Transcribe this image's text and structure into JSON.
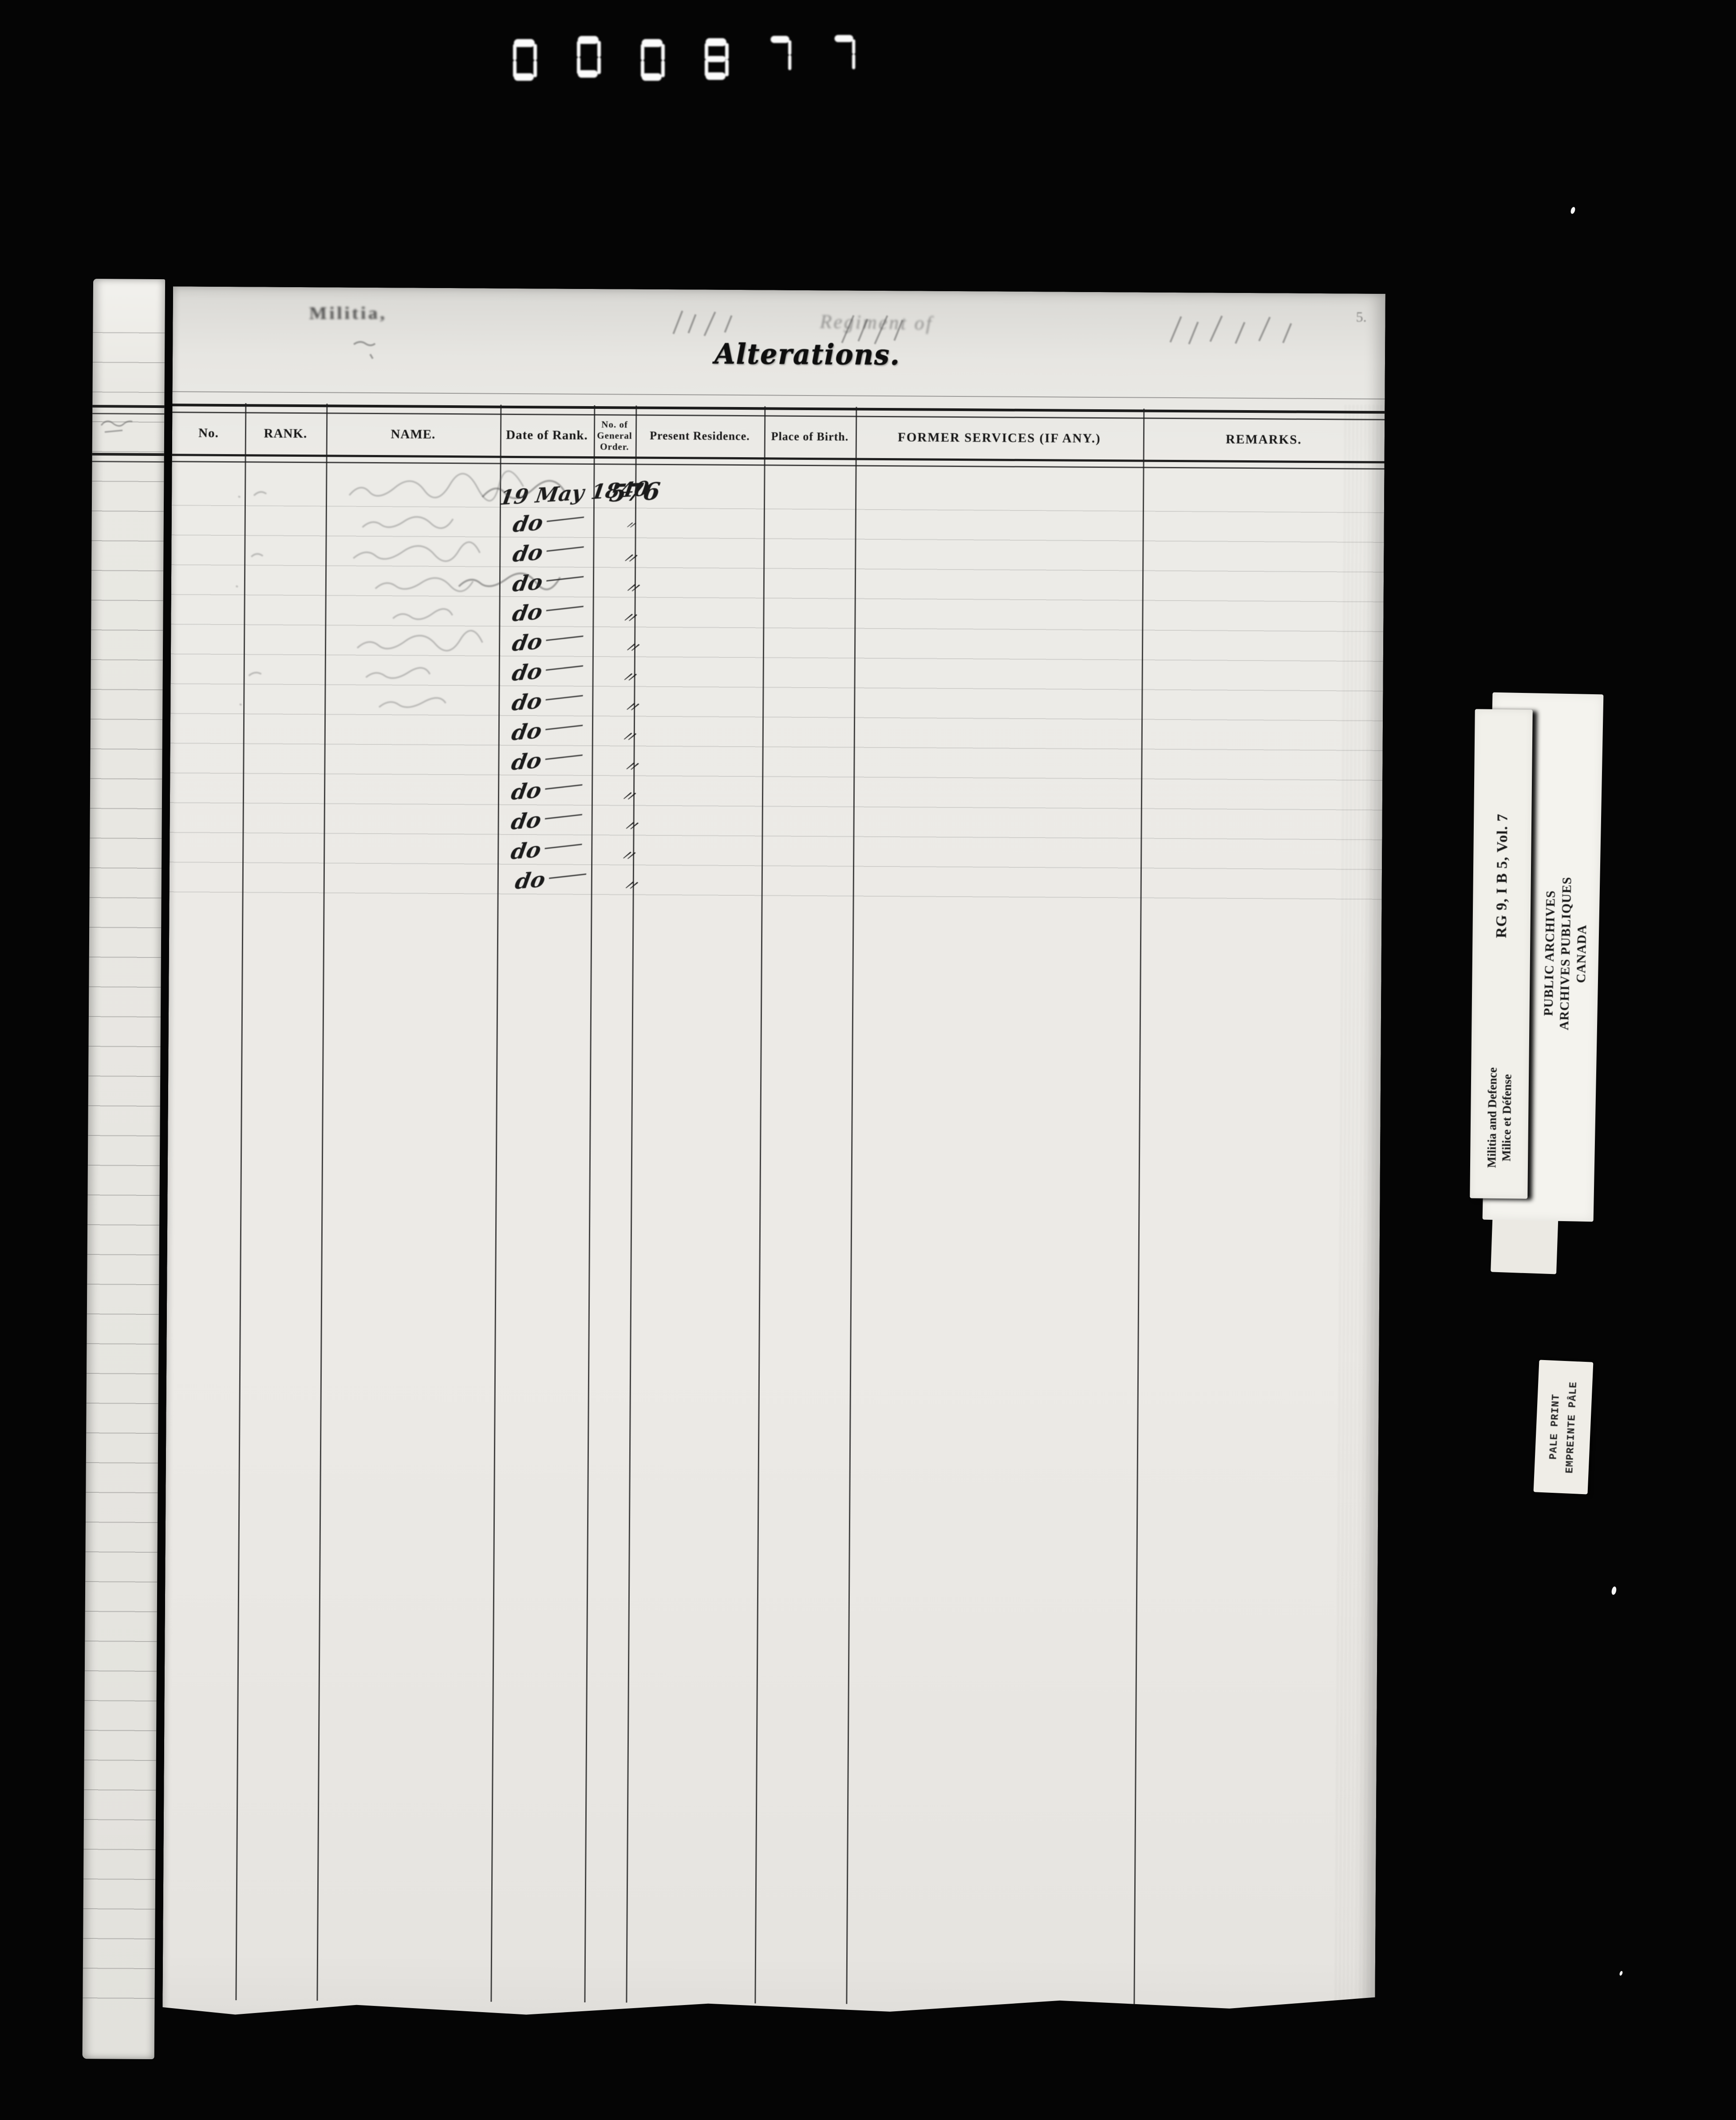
{
  "film": {
    "frame_number": "000877"
  },
  "page": {
    "form_header": {
      "faint_stamp": "Militia,",
      "faint_form_text": "Regiment of",
      "title": "Alterations.",
      "corner_mark": "5."
    },
    "table": {
      "columns": [
        "No.",
        "RANK.",
        "NAME.",
        "Date of Rank.",
        "No. of General Order.",
        "Present Residence.",
        "Place of Birth.",
        "FORMER SERVICES (IF ANY.)",
        "REMARKS."
      ],
      "rows": [
        {
          "date_of_rank": "19 May 1840",
          "general_order": "576"
        },
        {
          "date_of_rank": "do",
          "general_order": "〃"
        },
        {
          "date_of_rank": "do",
          "general_order": "〃"
        },
        {
          "date_of_rank": "do",
          "general_order": "〃"
        },
        {
          "date_of_rank": "do",
          "general_order": "〃"
        },
        {
          "date_of_rank": "do",
          "general_order": "〃"
        },
        {
          "date_of_rank": "do",
          "general_order": "〃"
        },
        {
          "date_of_rank": "do",
          "general_order": "〃"
        },
        {
          "date_of_rank": "do",
          "general_order": "〃"
        },
        {
          "date_of_rank": "do",
          "general_order": "〃"
        },
        {
          "date_of_rank": "do",
          "general_order": "〃"
        },
        {
          "date_of_rank": "do",
          "general_order": "〃"
        },
        {
          "date_of_rank": "do",
          "general_order": "〃"
        },
        {
          "date_of_rank": "do",
          "general_order": "〃"
        }
      ]
    }
  },
  "archive_labels": {
    "reference_card": {
      "reference": "RG 9, I B 5, Vol. 7",
      "department_en": "Militia and Defence",
      "department_fr": "Milice et Défense"
    },
    "archives_card": {
      "line1": "PUBLIC ARCHIVES",
      "line2": "ARCHIVES PUBLIQUES",
      "line3": "CANADA"
    },
    "quality_card": {
      "line1": "PALE PRINT",
      "line2": "EMPREINTE PÂLE"
    }
  },
  "colors": {
    "film_background": "#050505",
    "paper": "#eceae6",
    "card_paper": "#f4f3ee",
    "ink": "#1b1b1b"
  }
}
